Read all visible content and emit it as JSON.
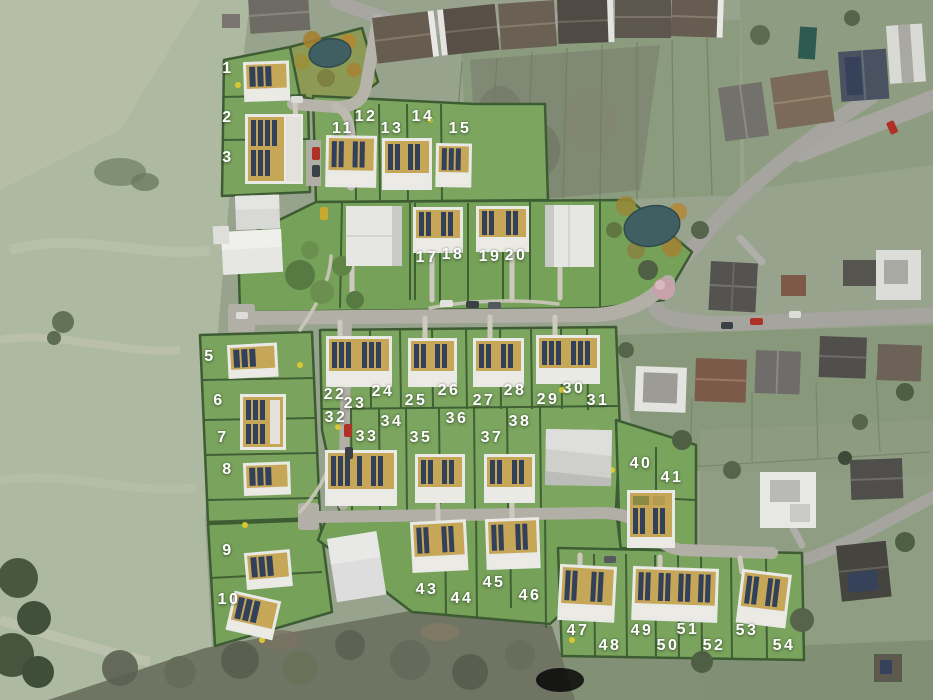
{
  "map": {
    "type": "aerial-development-site-plan",
    "label_color": "#ffffff"
  },
  "palette": {
    "field": "#aeb9a2",
    "existing_area": "#97a38c",
    "site_lawn": "#79a45c",
    "hedge": "#3e5c33",
    "road_existing": "#a6a49e",
    "road_new": "#b3b0a8",
    "building_white": "#e9e9e6",
    "roof_tan": "#c6a758",
    "solar_panel": "#33405a",
    "pond": "#3f5f63",
    "woodland": "#6f7463"
  },
  "plots": {
    "labels": [
      {
        "number": "1",
        "x": 228,
        "y": 69
      },
      {
        "number": "2",
        "x": 228,
        "y": 118
      },
      {
        "number": "3",
        "x": 228,
        "y": 158
      },
      {
        "number": "5",
        "x": 210,
        "y": 357
      },
      {
        "number": "6",
        "x": 219,
        "y": 401
      },
      {
        "number": "7",
        "x": 223,
        "y": 438
      },
      {
        "number": "8",
        "x": 228,
        "y": 470
      },
      {
        "number": "9",
        "x": 228,
        "y": 551
      },
      {
        "number": "10",
        "x": 229,
        "y": 600
      },
      {
        "number": "11",
        "x": 343,
        "y": 129
      },
      {
        "number": "12",
        "x": 366,
        "y": 117
      },
      {
        "number": "13",
        "x": 392,
        "y": 129
      },
      {
        "number": "14",
        "x": 423,
        "y": 117
      },
      {
        "number": "15",
        "x": 460,
        "y": 129
      },
      {
        "number": "17",
        "x": 427,
        "y": 258
      },
      {
        "number": "18",
        "x": 453,
        "y": 255
      },
      {
        "number": "19",
        "x": 490,
        "y": 257
      },
      {
        "number": "20",
        "x": 516,
        "y": 256
      },
      {
        "number": "22",
        "x": 335,
        "y": 395
      },
      {
        "number": "23",
        "x": 355,
        "y": 404
      },
      {
        "number": "24",
        "x": 383,
        "y": 392
      },
      {
        "number": "25",
        "x": 416,
        "y": 401
      },
      {
        "number": "26",
        "x": 449,
        "y": 391
      },
      {
        "number": "27",
        "x": 484,
        "y": 401
      },
      {
        "number": "28",
        "x": 515,
        "y": 391
      },
      {
        "number": "29",
        "x": 548,
        "y": 400
      },
      {
        "number": "30",
        "x": 574,
        "y": 389
      },
      {
        "number": "31",
        "x": 598,
        "y": 401
      },
      {
        "number": "32",
        "x": 336,
        "y": 418
      },
      {
        "number": "33",
        "x": 367,
        "y": 437
      },
      {
        "number": "34",
        "x": 392,
        "y": 422
      },
      {
        "number": "35",
        "x": 421,
        "y": 438
      },
      {
        "number": "36",
        "x": 457,
        "y": 419
      },
      {
        "number": "37",
        "x": 492,
        "y": 438
      },
      {
        "number": "38",
        "x": 520,
        "y": 422
      },
      {
        "number": "40",
        "x": 641,
        "y": 464
      },
      {
        "number": "41",
        "x": 672,
        "y": 478
      },
      {
        "number": "43",
        "x": 427,
        "y": 590
      },
      {
        "number": "44",
        "x": 462,
        "y": 599
      },
      {
        "number": "45",
        "x": 494,
        "y": 583
      },
      {
        "number": "46",
        "x": 530,
        "y": 596
      },
      {
        "number": "47",
        "x": 578,
        "y": 631
      },
      {
        "number": "48",
        "x": 610,
        "y": 646
      },
      {
        "number": "49",
        "x": 642,
        "y": 631
      },
      {
        "number": "50",
        "x": 668,
        "y": 646
      },
      {
        "number": "51",
        "x": 688,
        "y": 630
      },
      {
        "number": "52",
        "x": 714,
        "y": 646
      },
      {
        "number": "53",
        "x": 747,
        "y": 631
      },
      {
        "number": "54",
        "x": 784,
        "y": 646
      }
    ]
  }
}
